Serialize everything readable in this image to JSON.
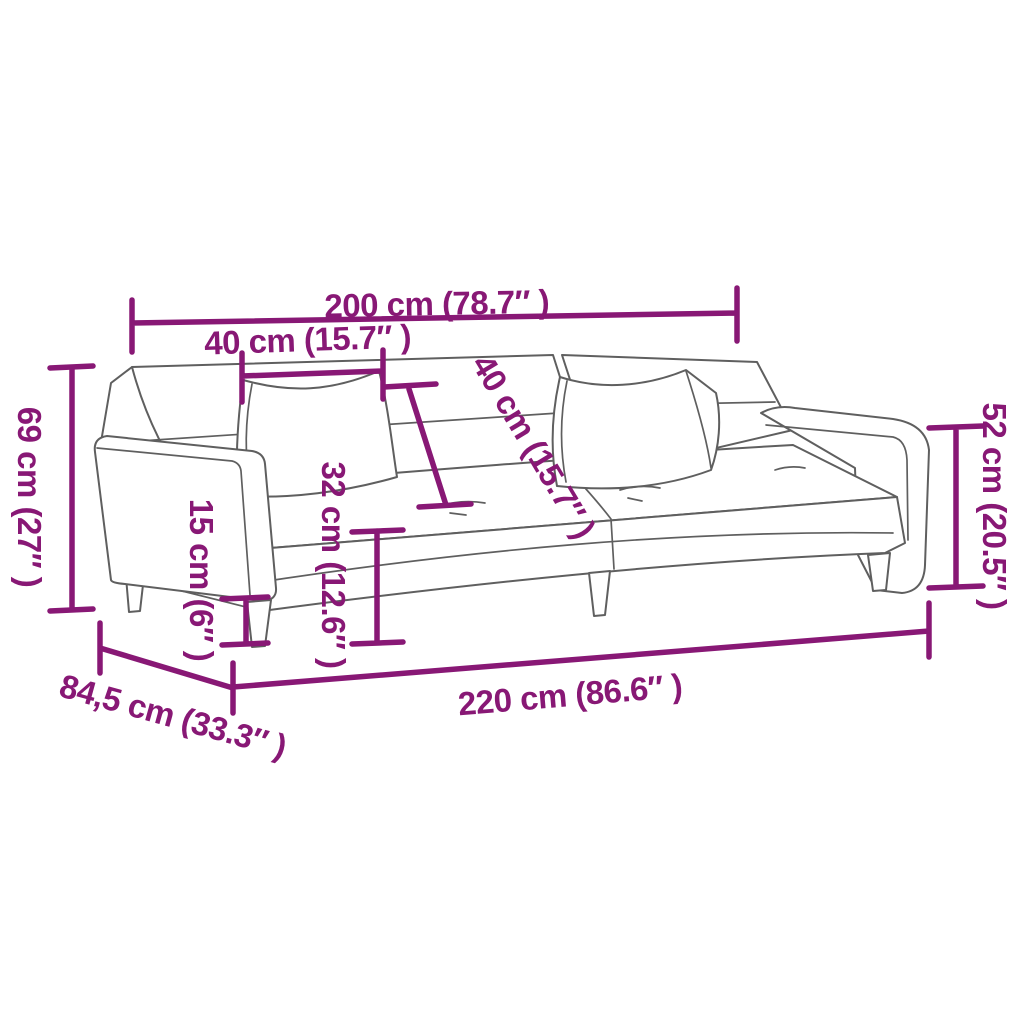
{
  "title": "Sofa bed dimension diagram",
  "colors": {
    "dimension": "#881875",
    "outline": "#5f5f5f",
    "background": "#ffffff"
  },
  "dims": {
    "total_width": {
      "label": "200 cm (78.7″ )"
    },
    "cushion_width": {
      "label": "40 cm (15.7″ )"
    },
    "total_height": {
      "label": "69 cm (27″ )"
    },
    "clearance_height": {
      "label": "15 cm (6″ )"
    },
    "seat_height": {
      "label": "32 cm (12.6″ )"
    },
    "backrest_width": {
      "label": "40 cm (15.7″ )"
    },
    "backrest_height": {
      "label": "52 cm (20.5″ )"
    },
    "total_length": {
      "label": "220 cm (86.6″ )"
    },
    "total_depth": {
      "label": "84,5 cm (33.3″ )"
    }
  }
}
